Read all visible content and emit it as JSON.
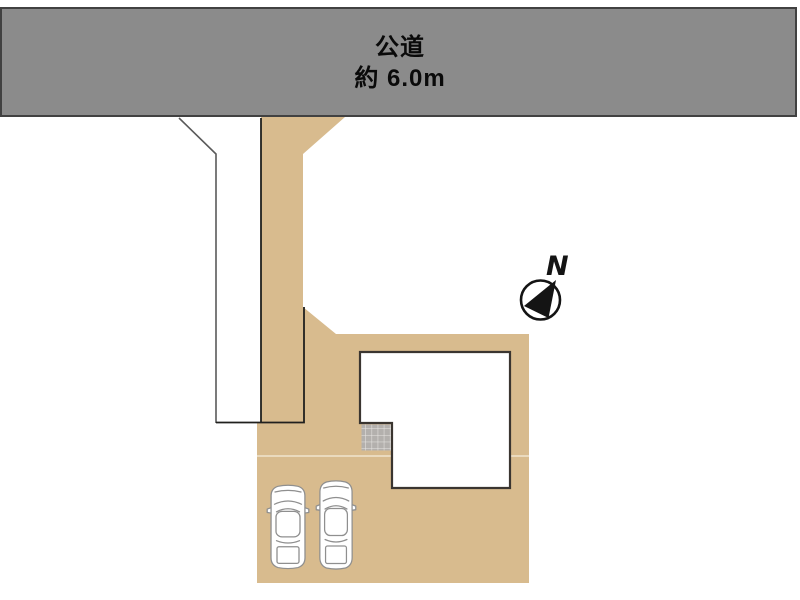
{
  "road": {
    "name_label": "公道",
    "width_label": "約 6.0m"
  },
  "compass": {
    "north_label": "N"
  },
  "site": {
    "parked_cars_count": 2
  },
  "colors": {
    "canvas_bg": "#ffffff",
    "road_fill": "#8b8b8b",
    "road_border": "#414141",
    "road_text": "#0a0a0a",
    "plot_fill": "#d8bb8e",
    "boundary_dark": "#20201e",
    "boundary_gray": "#5a5a5a",
    "divider_line": "#f4ecdc",
    "building_fill": "#ffffff",
    "building_border": "#3a3530",
    "porch_fill": "#b3b0ad",
    "porch_grid": "#eae8e5",
    "car_fill": "#ffffff",
    "car_stroke": "#8f8f8f",
    "compass_color": "#141414"
  }
}
